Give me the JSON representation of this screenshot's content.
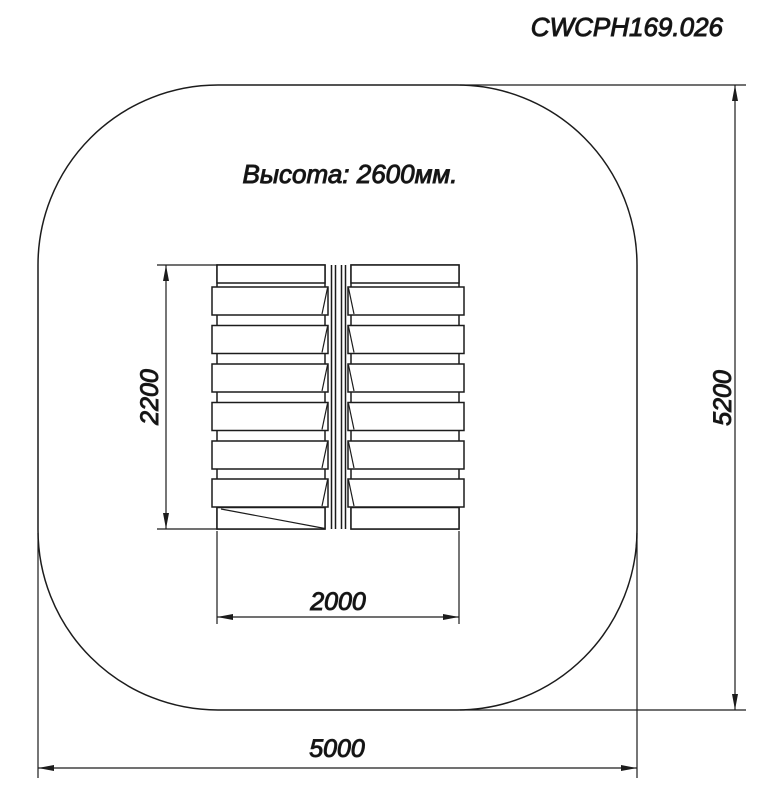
{
  "drawing": {
    "code": "CWCPH169.026",
    "height_note": "Высота: 2600мм.",
    "dimensions": {
      "equipment_depth": "2200",
      "equipment_width": "2000",
      "safety_zone_width": "5000",
      "safety_zone_depth": "5200"
    },
    "colors": {
      "line": "#1c1c1c",
      "background": "#ffffff"
    }
  }
}
